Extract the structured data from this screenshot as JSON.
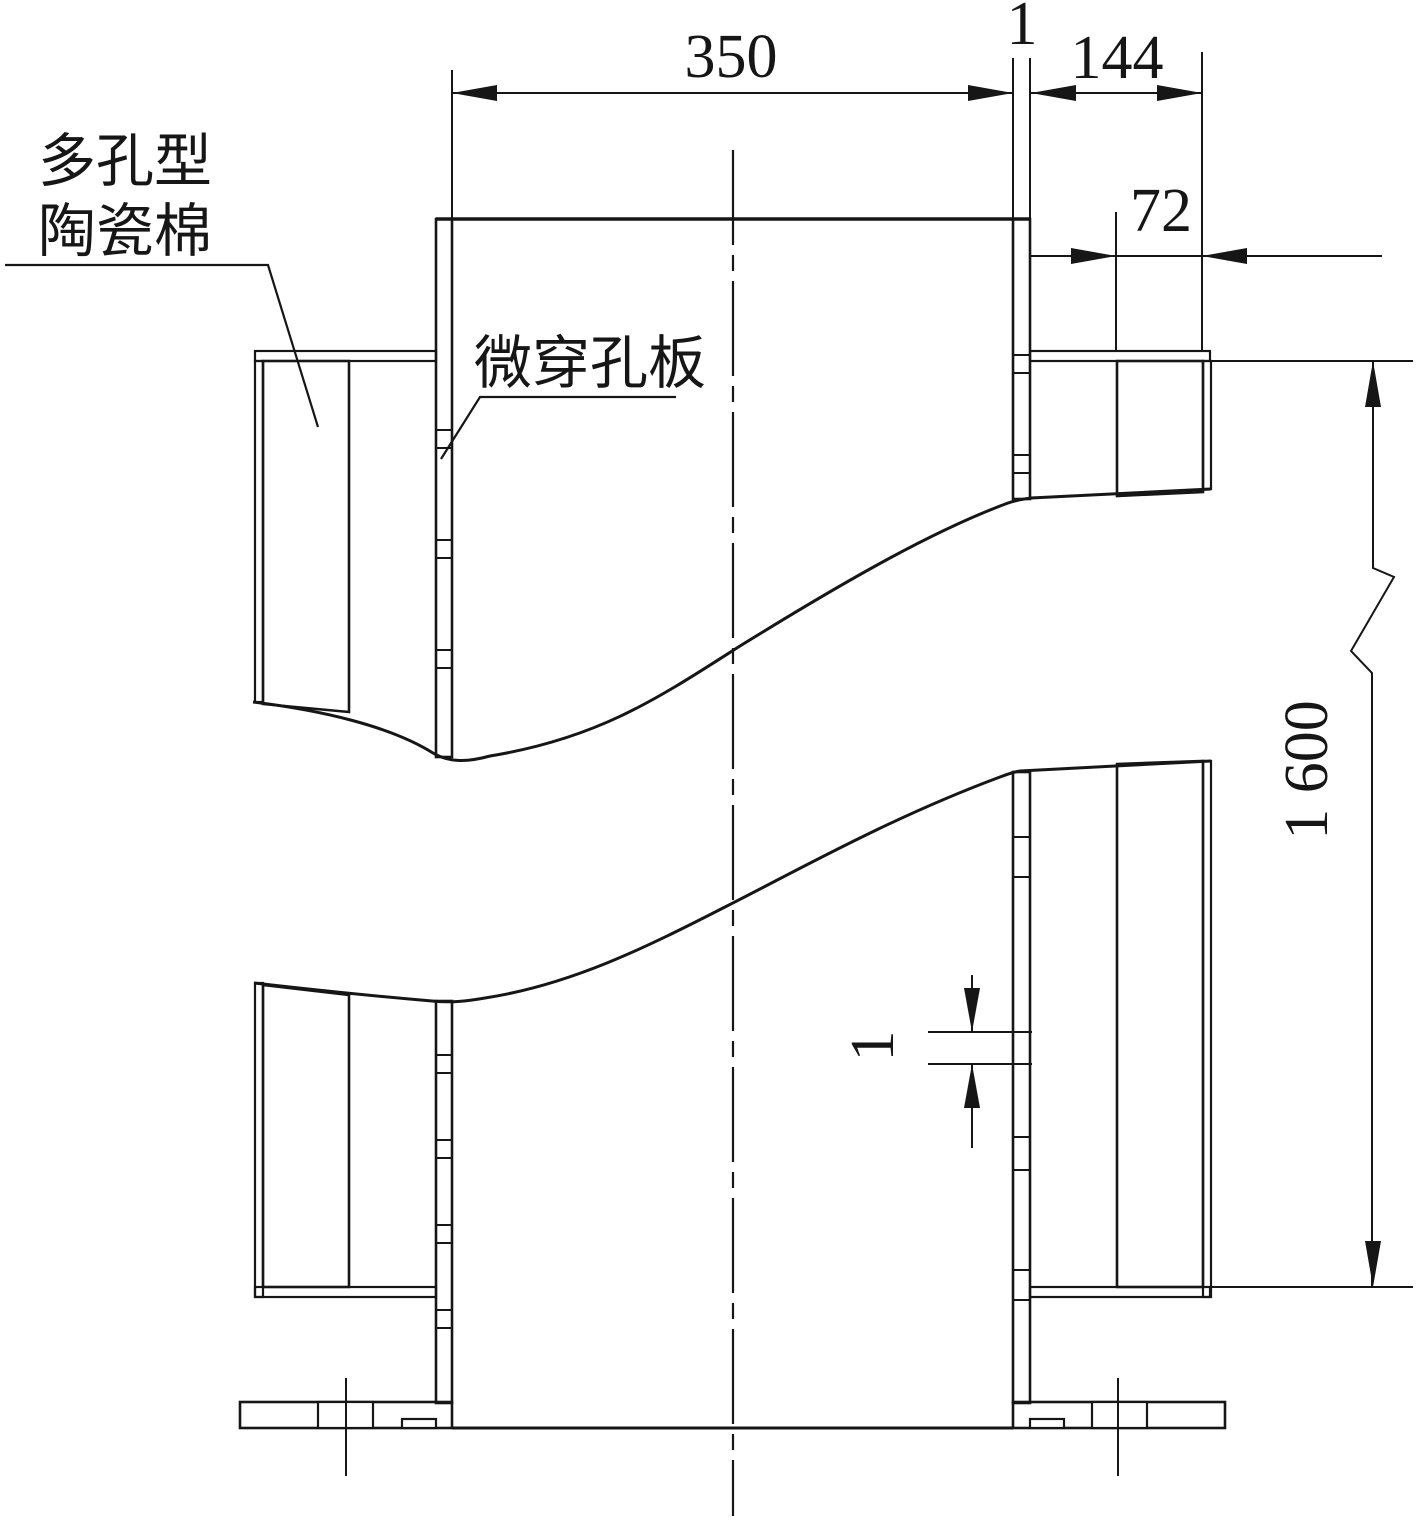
{
  "drawing": {
    "background": "#ffffff",
    "line_color": "#161616",
    "labels": {
      "porous_ceramic_wool_line1": "多孔型",
      "porous_ceramic_wool_line2": "陶瓷棉",
      "micro_perforated_panel": "微穿孔板"
    },
    "dimensions": {
      "duct_inner_width": "350",
      "panel_thickness": "1",
      "side_cavity_depth": "144",
      "wool_layer_depth": "72",
      "section_height": "1 600",
      "perforation_size": "1"
    }
  }
}
